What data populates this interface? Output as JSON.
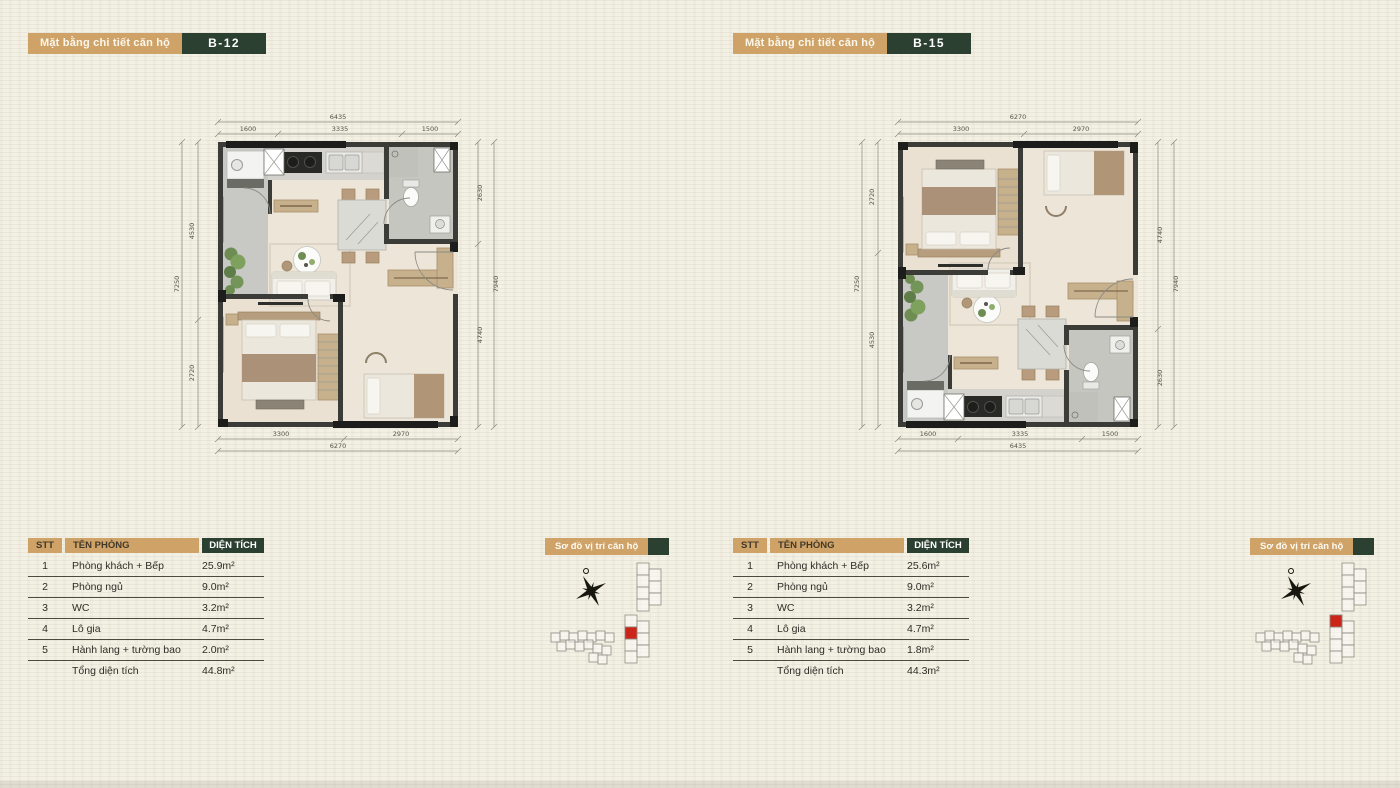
{
  "colors": {
    "tan": "#cfa368",
    "green": "#2c4031",
    "red": "#cc2418"
  },
  "panels": [
    {
      "header": {
        "label": "Mặt bằng chi tiết căn hộ",
        "badge": "B-12"
      },
      "dims": {
        "top": [
          "1600",
          "3335",
          "1500"
        ],
        "top_total": "6435",
        "bottom": [
          "3300",
          "2970"
        ],
        "bottom_total": "6270",
        "left": [
          "4530",
          "2720"
        ],
        "left_total": "7250",
        "right": [
          "2630",
          "4740"
        ],
        "right_total": "7940"
      },
      "table": {
        "headers": {
          "stt": "STT",
          "room": "TÊN PHÒNG",
          "area": "DIỆN TÍCH"
        },
        "rows": [
          {
            "stt": "1",
            "room": "Phòng khách + Bếp",
            "area": "25.9m²"
          },
          {
            "stt": "2",
            "room": "Phòng ngủ",
            "area": "9.0m²"
          },
          {
            "stt": "3",
            "room": "WC",
            "area": "3.2m²"
          },
          {
            "stt": "4",
            "room": "Lô gia",
            "area": "4.7m²"
          },
          {
            "stt": "5",
            "room": "Hành lang + tường bao",
            "area": "2.0m²"
          }
        ],
        "total": {
          "label": "Tổng diện tích",
          "area": "44.8m²"
        }
      },
      "site": {
        "label": "Sơ đồ vị trí căn hộ",
        "red_y": "64"
      }
    },
    {
      "header": {
        "label": "Mặt bằng chi tiết căn hộ",
        "badge": "B-15"
      },
      "dims": {
        "top": [
          "3300",
          "2970"
        ],
        "top_total": "6270",
        "bottom": [
          "1600",
          "3335",
          "1500"
        ],
        "bottom_total": "6435",
        "left": [
          "2720",
          "4530"
        ],
        "left_total": "7250",
        "right": [
          "4740",
          "2630"
        ],
        "right_total": "7940"
      },
      "table": {
        "headers": {
          "stt": "STT",
          "room": "TÊN PHÒNG",
          "area": "DIỆN TÍCH"
        },
        "rows": [
          {
            "stt": "1",
            "room": "Phòng khách + Bếp",
            "area": "25.6m²"
          },
          {
            "stt": "2",
            "room": "Phòng ngủ",
            "area": "9.0m²"
          },
          {
            "stt": "3",
            "room": "WC",
            "area": "3.2m²"
          },
          {
            "stt": "4",
            "room": "Lô gia",
            "area": "4.7m²"
          },
          {
            "stt": "5",
            "room": "Hành lang + tường bao",
            "area": "1.8m²"
          }
        ],
        "total": {
          "label": "Tổng diện tích",
          "area": "44.3m²"
        }
      },
      "site": {
        "label": "Sơ đồ vị trí căn hộ",
        "red_y": "52"
      }
    }
  ]
}
